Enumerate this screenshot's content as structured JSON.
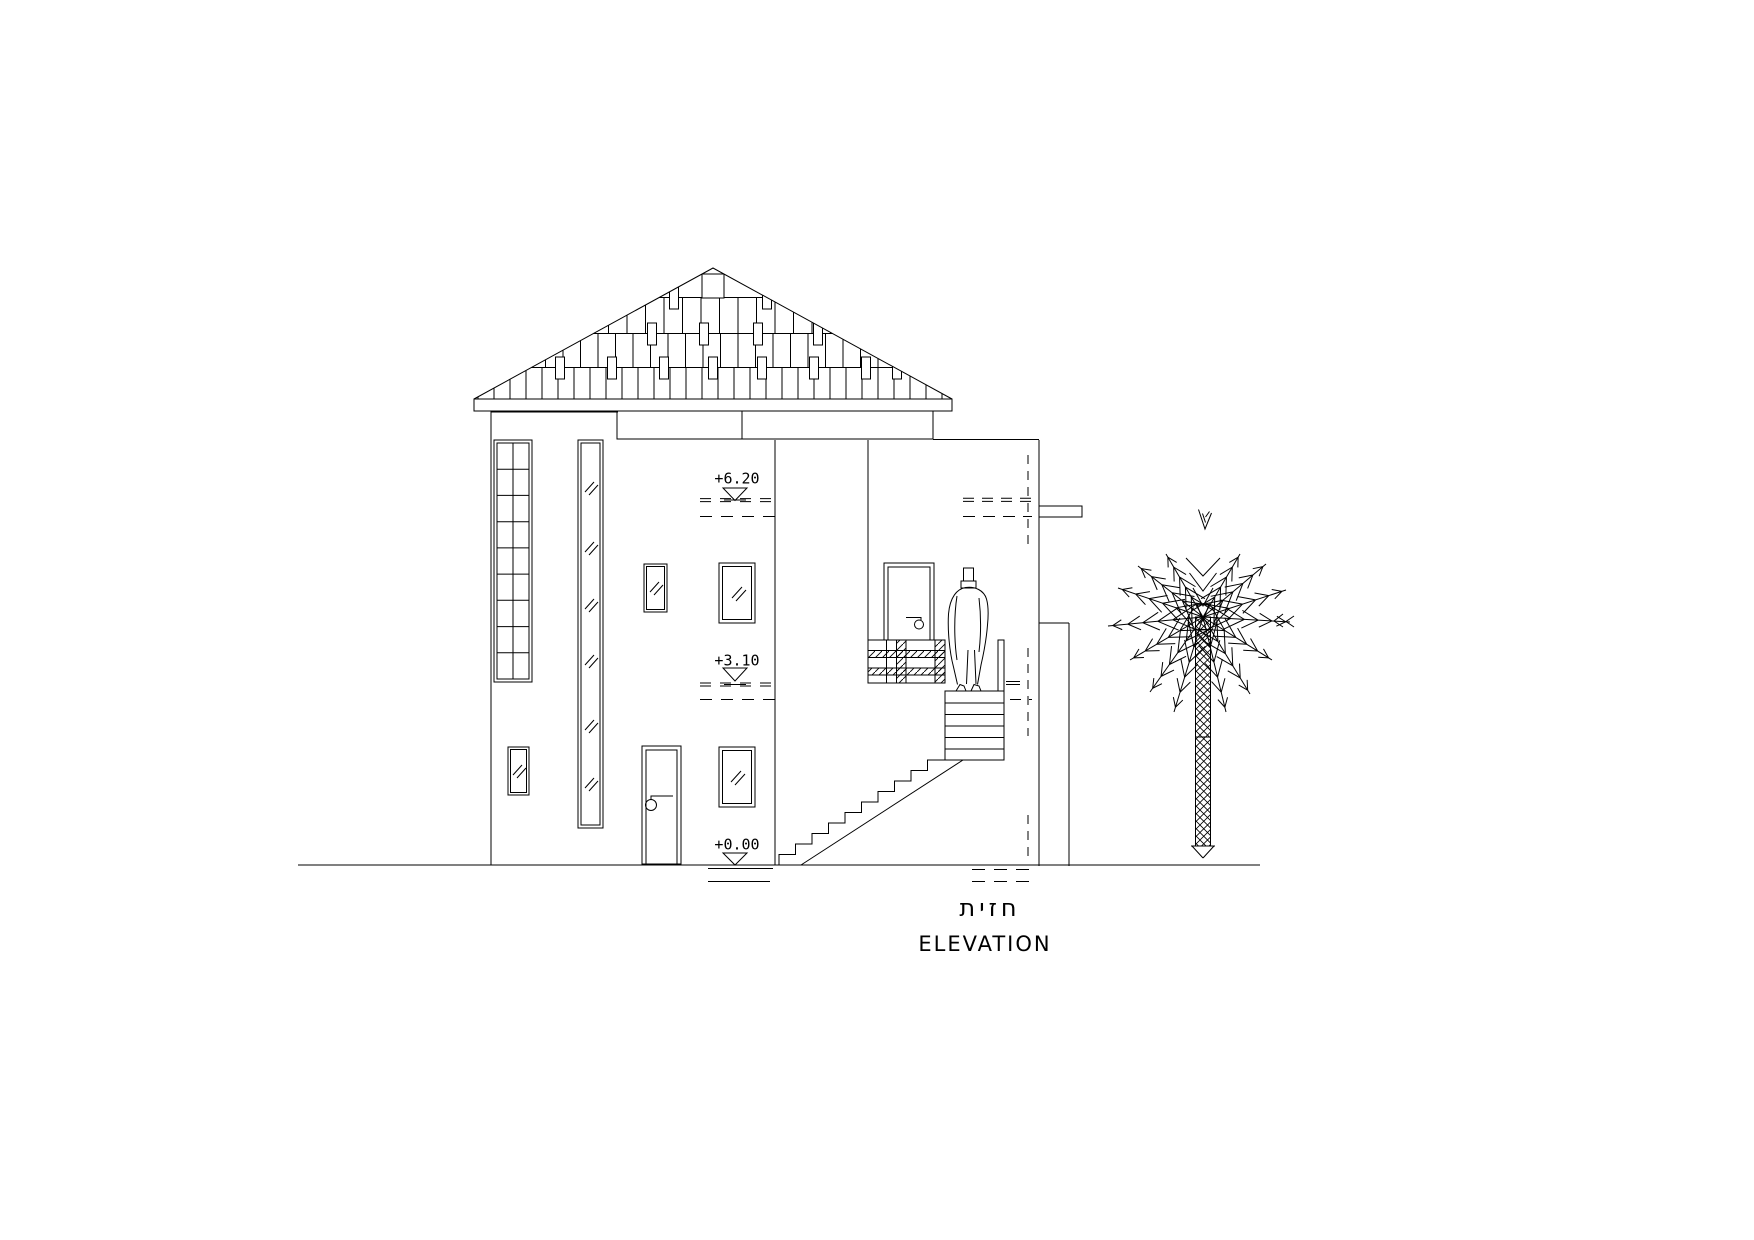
{
  "page": {
    "background": "#ffffff",
    "line_color": "#000000"
  },
  "drawing": {
    "caption": {
      "hebrew": "חזית",
      "english": "ELEVATION"
    },
    "level_markers": [
      {
        "label": "+6.20"
      },
      {
        "label": "+3.10"
      },
      {
        "label": "+0.00"
      }
    ]
  }
}
